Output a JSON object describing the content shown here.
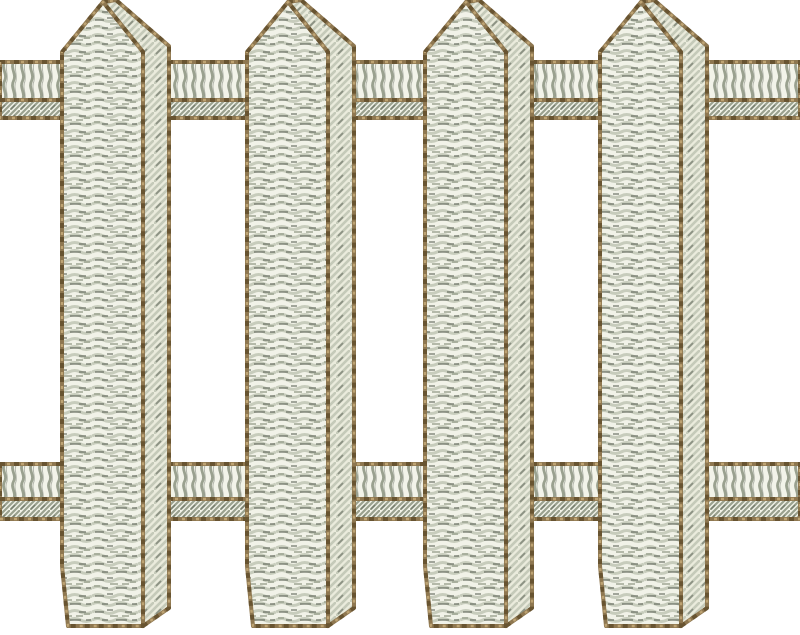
{
  "design": {
    "kind": "embroidery-stitch-design",
    "subject": "white picket fence",
    "canvas": {
      "width": 800,
      "height": 635,
      "background": "#ffffff"
    },
    "palette": {
      "outline": "#8e7750",
      "outline_dark": "#5f4b29",
      "outline_light": "#c2a777",
      "stitch_light": "#f1f2e8",
      "stitch_mid": "#c5cab9",
      "stitch_shadow": "#9aa18f",
      "stitch_dark": "#51584b",
      "side_light": "#eaebdc",
      "rail_light": "#f2f3e9"
    },
    "fence": {
      "x_start": 0,
      "x_end": 800,
      "pickets": {
        "count": 4,
        "xs": [
          62,
          247,
          425,
          600
        ],
        "main_width": 81,
        "side_width": 26,
        "apex_y": 2,
        "shoulder_y": 52,
        "side_top_dx": 13,
        "side_top_y": 0,
        "side_shoulder_y": 46,
        "bottom_y": 626,
        "side_bottom_y": 608,
        "bevel_top_y": 566,
        "bevel_dx": 6
      },
      "rails": [
        {
          "name": "top-rail",
          "bands": [
            {
              "y": 62,
              "height": 38,
              "texture": "coil"
            },
            {
              "y": 100,
              "height": 18,
              "texture": "twill"
            }
          ]
        },
        {
          "name": "bottom-rail",
          "bands": [
            {
              "y": 464,
              "height": 35,
              "texture": "coil"
            },
            {
              "y": 499,
              "height": 20,
              "texture": "twill"
            }
          ]
        }
      ]
    }
  }
}
